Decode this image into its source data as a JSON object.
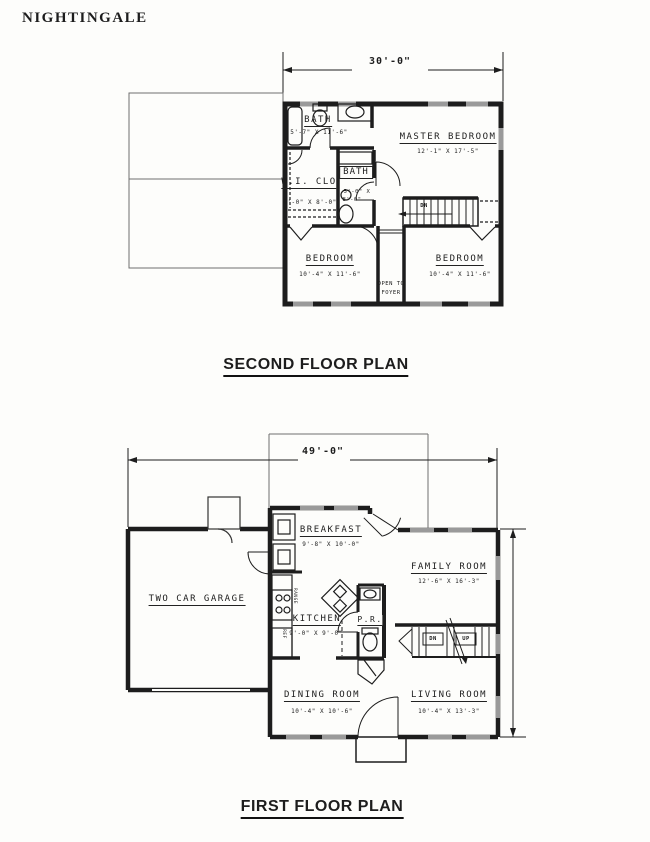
{
  "header": {
    "title": "NIGHTINGALE"
  },
  "colors": {
    "line": "#1d1d1d",
    "window_gray": "#9a9a9a",
    "faint": "#6f6f6f",
    "bg": "#fdfdfb"
  },
  "second_floor": {
    "caption": "SECOND FLOOR PLAN",
    "width_dim": "30'-0\"",
    "rooms": {
      "bath1": {
        "name": "BATH",
        "dim": "5'-7\" X 11'-6\""
      },
      "master": {
        "name": "MASTER BEDROOM",
        "dim": "12'-1\" X 17'-5\""
      },
      "wic": {
        "name": "W.I. CLO",
        "dim": "6'-0\" X 8'-0\""
      },
      "bath2": {
        "name": "BATH",
        "dim_line1": "5'-0\" X",
        "dim_line2": "8'-0\""
      },
      "bedroom_left": {
        "name": "BEDROOM",
        "dim": "10'-4\" X 11'-6\""
      },
      "bedroom_right": {
        "name": "BEDROOM",
        "dim": "10'-4\" X 11'-6\""
      },
      "foyer_note_line1": "OPEN TO",
      "foyer_note_line2": "FOYER",
      "stair_label": "DN"
    }
  },
  "first_floor": {
    "caption": "FIRST FLOOR PLAN",
    "width_dim": "49'-0\"",
    "rooms": {
      "garage": {
        "name": "TWO CAR GARAGE"
      },
      "breakfast": {
        "name": "BREAKFAST",
        "dim": "9'-8\" X 10'-0\""
      },
      "family": {
        "name": "FAMILY ROOM",
        "dim": "12'-6\" X 16'-3\""
      },
      "kitchen": {
        "name": "KITCHEN",
        "dim": "9'-0\" X 9'-0\""
      },
      "powder": {
        "name": "P.R."
      },
      "dining": {
        "name": "DINING ROOM",
        "dim": "10'-4\" X 10'-6\""
      },
      "living": {
        "name": "LIVING ROOM",
        "dim": "10'-4\" X 13'-3\""
      },
      "stair_down": "DN",
      "stair_up": "UP",
      "range_label": "RANGE",
      "ref_label": "REF"
    }
  }
}
